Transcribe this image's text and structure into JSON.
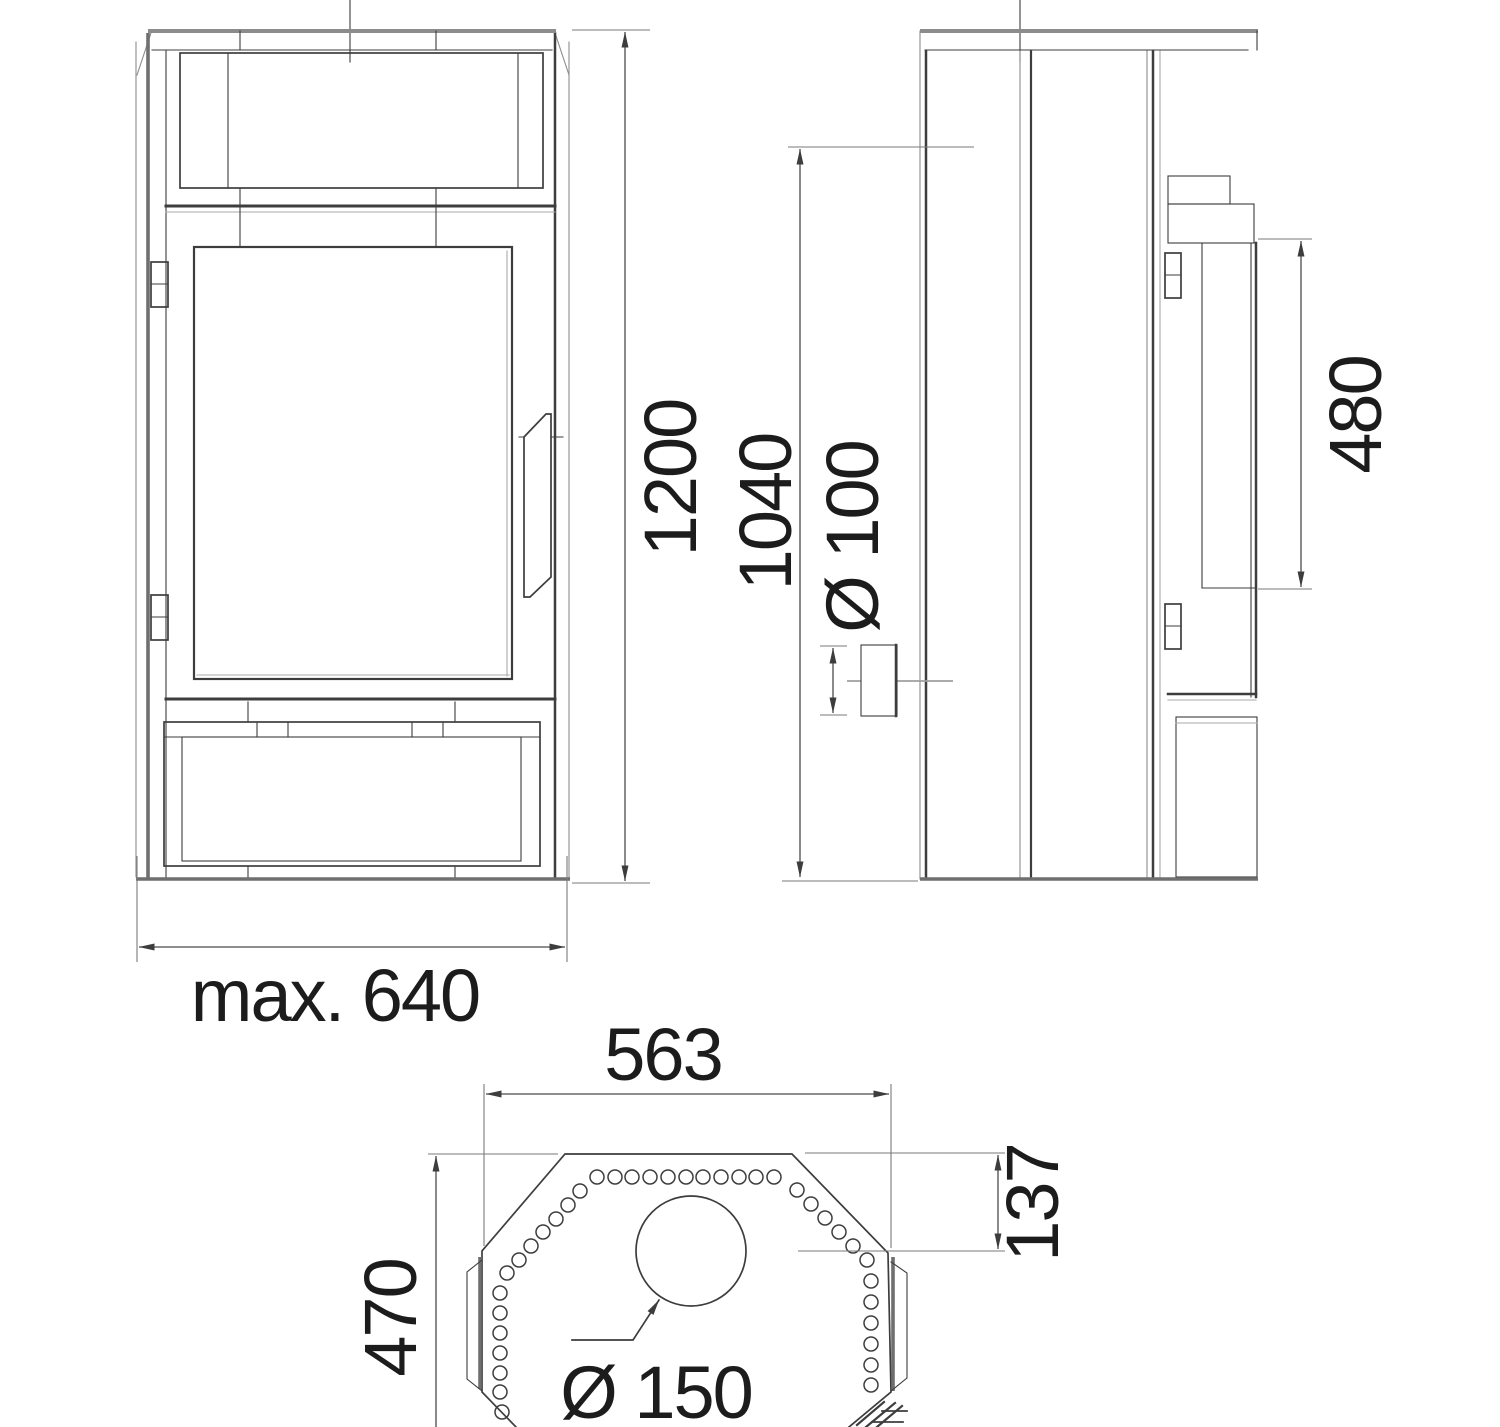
{
  "drawing": {
    "dimensions": {
      "overall_height": "1200",
      "rear_flue_height": "1040",
      "rear_flue_diameter": "Ø 100",
      "glass_height": "480",
      "max_width": "max. 640",
      "top_plate_width": "563",
      "top_edge_inset": "137",
      "depth": "470",
      "top_flue_diameter": "Ø 150"
    },
    "colors": {
      "line": "#3d3d3d",
      "shade": "#8c8c8c",
      "dimension": "#4b4b4b",
      "text": "#1c1c1c",
      "background": "#ffffff"
    }
  }
}
